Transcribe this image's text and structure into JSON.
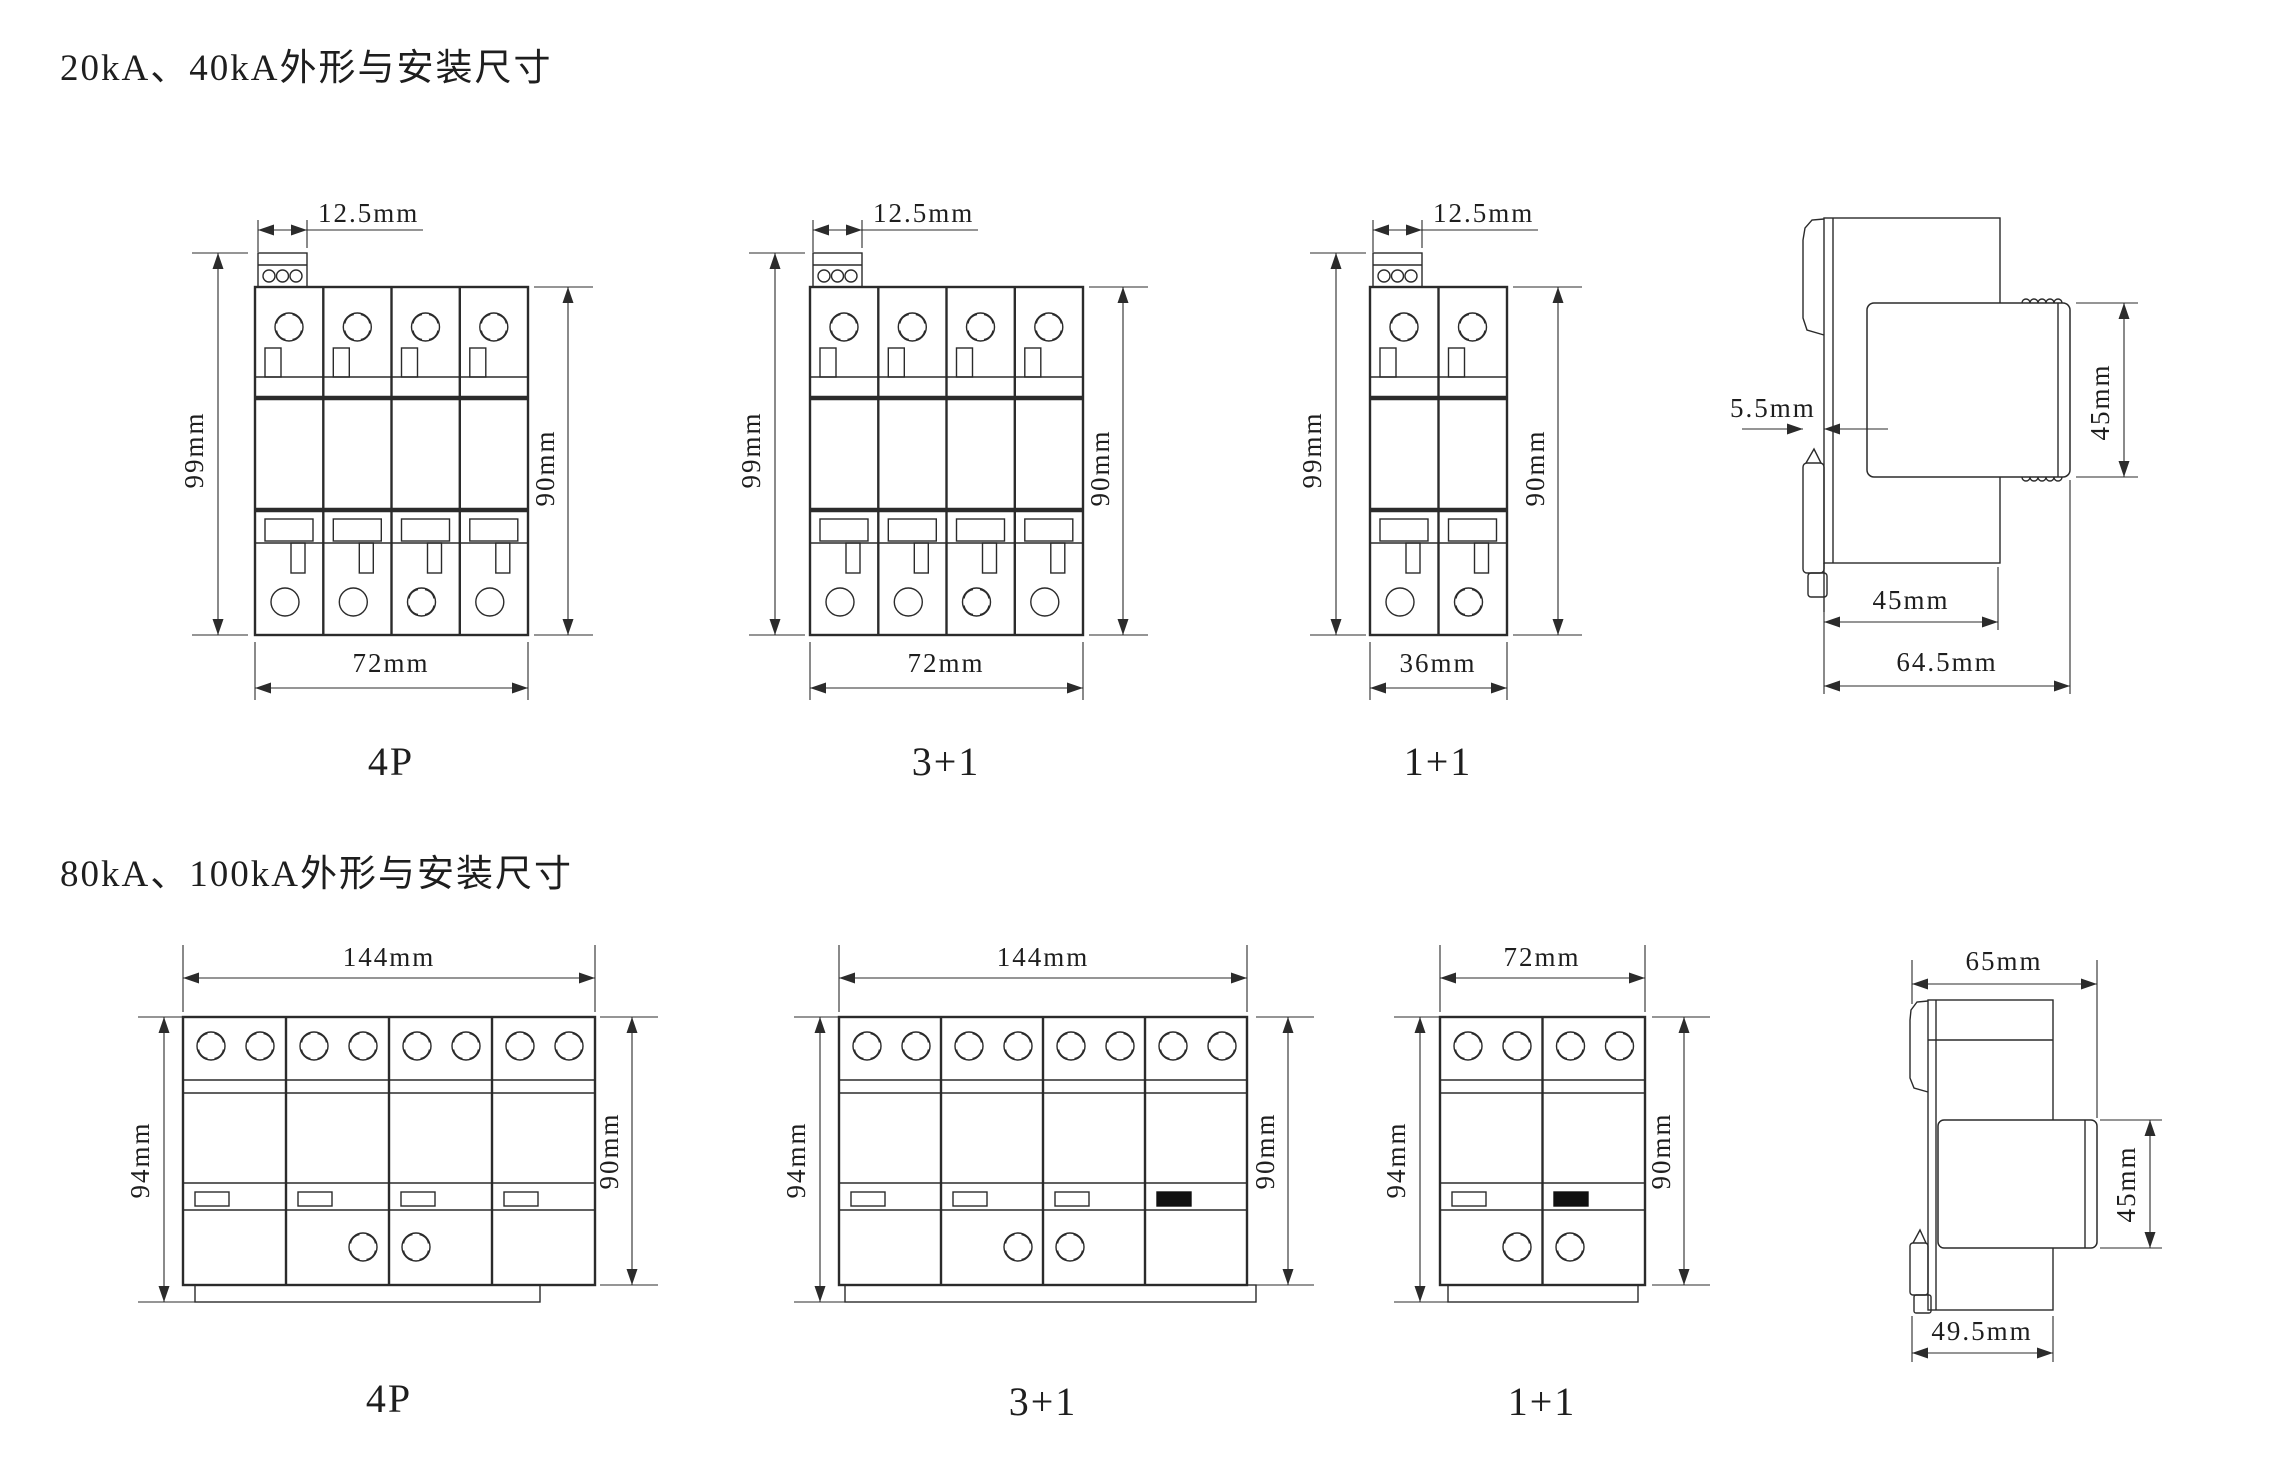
{
  "colors": {
    "line": "#2b2b2b",
    "background": "#ffffff",
    "text": "#1e1e1e"
  },
  "s1": {
    "title": "20kA、40kA外形与安装尺寸",
    "devices": [
      {
        "label": "4P",
        "dim_top": "12.5mm",
        "dim_left": "99mm",
        "dim_right": "90mm",
        "dim_bottom": "72mm"
      },
      {
        "label": "3+1",
        "dim_top": "12.5mm",
        "dim_left": "99mm",
        "dim_right": "90mm",
        "dim_bottom": "72mm"
      },
      {
        "label": "1+1",
        "dim_top": "12.5mm",
        "dim_left": "99mm",
        "dim_right": "90mm",
        "dim_bottom": "36mm"
      }
    ],
    "side": {
      "dim_gap": "5.5mm",
      "dim_module": "45mm",
      "dim_depth": "45mm",
      "dim_total": "64.5mm"
    }
  },
  "s2": {
    "title": "80kA、100kA外形与安装尺寸",
    "devices": [
      {
        "label": "4P",
        "dim_top": "144mm",
        "dim_left": "94mm",
        "dim_right": "90mm"
      },
      {
        "label": "3+1",
        "dim_top": "144mm",
        "dim_left": "94mm",
        "dim_right": "90mm"
      },
      {
        "label": "1+1",
        "dim_top": "72mm",
        "dim_left": "94mm",
        "dim_right": "90mm"
      }
    ],
    "side": {
      "dim_top": "65mm",
      "dim_right": "45mm",
      "dim_bottom": "49.5mm"
    }
  }
}
